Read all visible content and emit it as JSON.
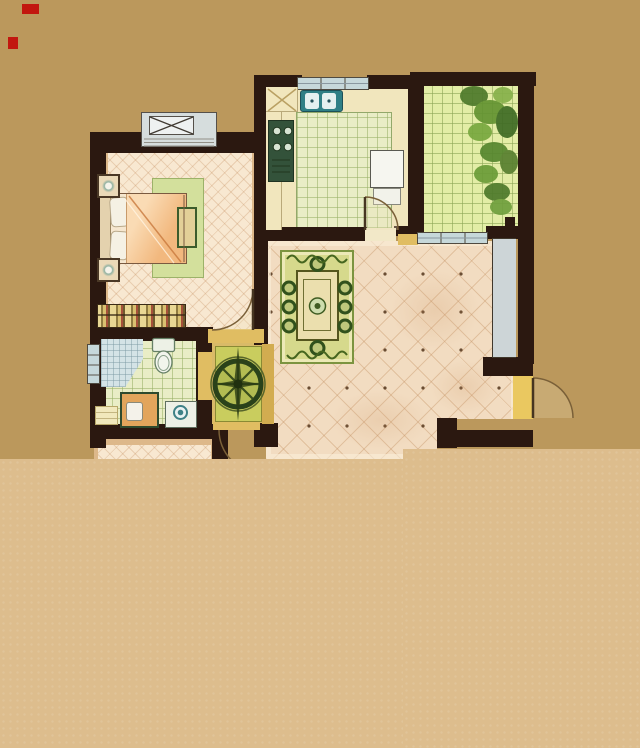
{
  "scene": {
    "type": "floor-plan",
    "description": "Hand-rendered watercolor apartment floor plan seen from above; lower portion of the plan is cut off by a plain light-tan band",
    "canvas_w": 640,
    "canvas_h": 748
  },
  "palette": {
    "bg_top": "#bb985c",
    "bg_bottom": "#ddbd8d",
    "wall": "#2b1810",
    "jamb": "#e0bd62",
    "jamb_pale": "#f2e8c8",
    "jamb_bright": "#eac860",
    "partition": "#d2ac50",
    "window_fill": "#c6d8da",
    "niche_fill": "#cdd5d7",
    "floor_warm": "#f8e8d1",
    "floor_dining": "#f2dcc1",
    "tile_green": "#e9edc6",
    "balcony_fill": "#e3eda6",
    "rug_green": "#d6d98c",
    "rug_hall": "#c9cd5e",
    "rug_bed": "#d3e09c",
    "hallway_bg": "#d9ba68",
    "counter": "#f1e6bd",
    "teal": "#2f7f86",
    "stove": "#33523a",
    "fridge": "#f6f6f0",
    "table": "#ebdfae",
    "chair": "#31511c",
    "compass_ring": "#2a421a",
    "compass_fill": "#b3bc52",
    "bed_blanket": "#f2b87e",
    "bed_blanket_light": "#fadbb4",
    "pillow": "#f5f1e4",
    "wood_trim": "#ddb88a",
    "dresser_a": "#e9d794",
    "dresser_b": "#8f7a40",
    "dresser_c": "#a5503a",
    "vanity": "#e2a55c",
    "shower": "#d4e3e6",
    "plant_dark": "#4e7a2b",
    "plant_mid": "#639331",
    "plant_light": "#86b14a",
    "arc_line": "#7a6038",
    "leaf": "#463521",
    "red_mark": "#c2170f"
  },
  "rooms": [
    {
      "id": "bedroom",
      "floor": "warm-crosshatch",
      "fixtures": [
        "casement-window",
        "double-bed",
        "pillows",
        "nightstand",
        "nightstand",
        "foot-bench",
        "area-rug",
        "striped-dresser",
        "door-arc"
      ]
    },
    {
      "id": "kitchen",
      "floor": "green-tile",
      "fixtures": [
        "window",
        "double-basin-sink",
        "corner-cabinet",
        "stove",
        "fridge",
        "counter",
        "door-arc"
      ]
    },
    {
      "id": "balcony",
      "floor": "green-tile",
      "fixtures": [
        "plants",
        "planter-pot",
        "window"
      ]
    },
    {
      "id": "dining-room",
      "floor": "diamond-tile-dots",
      "fixtures": [
        "dining-table",
        "eight-chairs",
        "area-rug",
        "centerpiece-plant",
        "bay-niche",
        "entry-door-arc"
      ]
    },
    {
      "id": "bathroom",
      "floor": "green-tile",
      "fixtures": [
        "corner-shower",
        "toilet",
        "vanity",
        "washing-machine",
        "floor-mat",
        "window",
        "door-opening"
      ]
    },
    {
      "id": "hallway",
      "floor": "rug",
      "fixtures": [
        "compass-medallion-rug",
        "door-arc"
      ]
    },
    {
      "id": "lower-room",
      "floor": "warm-crosshatch",
      "fixtures": []
    }
  ],
  "marks": [
    {
      "id": "red-mark-1"
    },
    {
      "id": "red-mark-2"
    }
  ]
}
